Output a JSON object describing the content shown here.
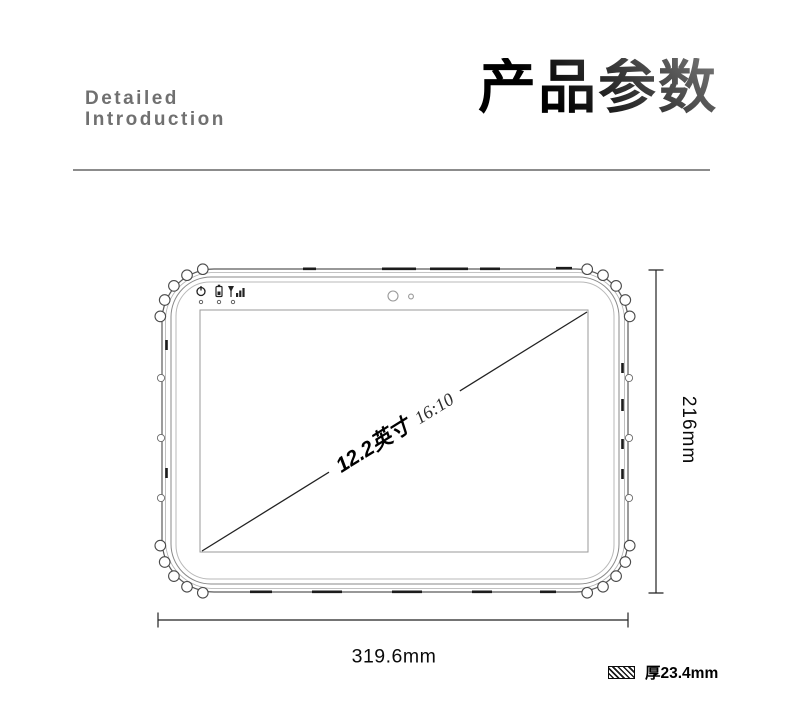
{
  "header": {
    "left_title_line1": "Detailed",
    "left_title_line2": "Introduction",
    "right_title": "产品参数"
  },
  "diagram": {
    "screen_size": "12.2英寸",
    "aspect_ratio": "16:10",
    "height_label": "216mm",
    "width_label": "319.6mm",
    "thickness_label": "厚23.4mm",
    "icons": [
      "power-icon",
      "battery-icon",
      "signal-icon",
      "front-camera-icon",
      "light-sensor-icon",
      "hatch-swatch-icon"
    ]
  },
  "colors": {
    "title_gradient_dark": "#000000",
    "title_gradient_light": "#787878",
    "subtitle_gray": "#707070",
    "divider_gray": "#8c8c8c",
    "line_art_dark": "#222222",
    "line_art_light": "#9a9a9a"
  }
}
